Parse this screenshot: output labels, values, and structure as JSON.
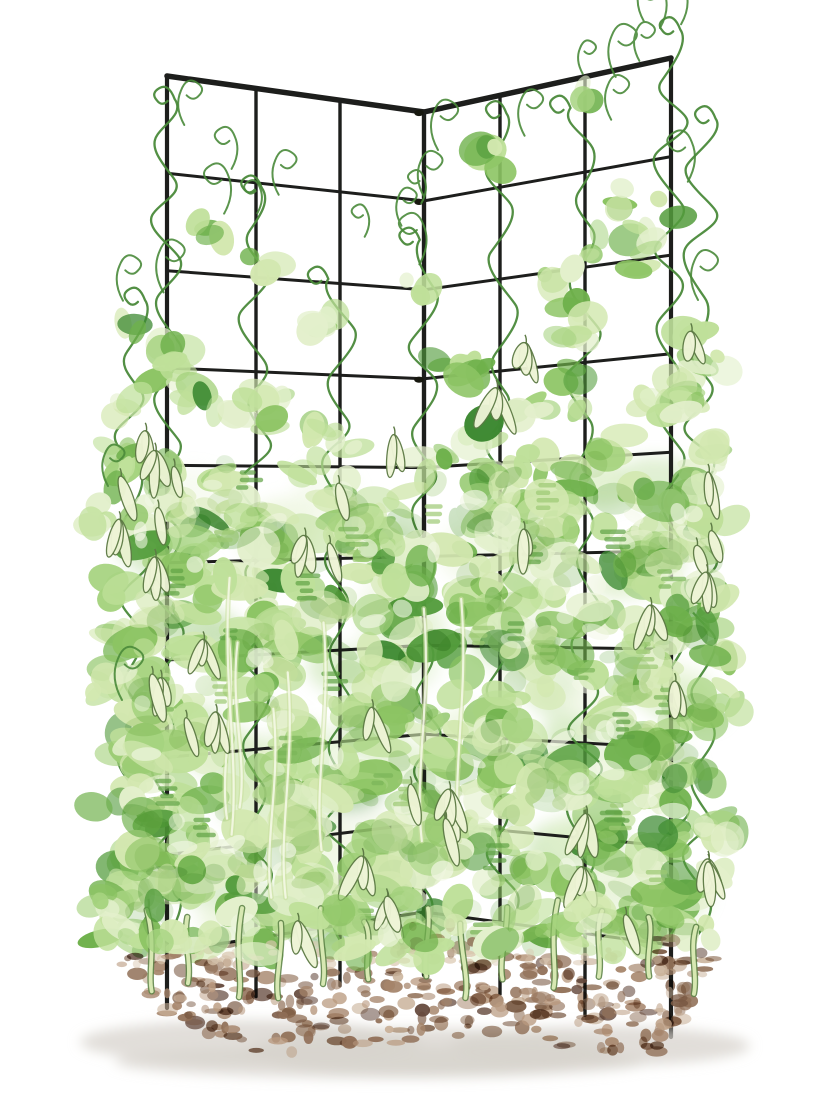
{
  "scene": {
    "width": 840,
    "height": 1120,
    "background": "#ffffff",
    "description": "Watercolor illustration of a two-panel corner pea trellis covered in climbing pea vines with hanging pea pods, planted in a mounded soil bed"
  },
  "palette": {
    "trellis": "#1d1e1c",
    "clamp": "#17180f",
    "vine": "#4a8a3a",
    "pod_fill": "#eef4d6",
    "pod_stroke": "#5d7a45",
    "stem_outline": "#5f8549",
    "stem_fill": "#d7e8b2",
    "light_stem_under": "#c9dfa0",
    "light_stem_top": "#f4f8e6",
    "highlight": "#f3f8e6",
    "soil_light": "#d9c6ae",
    "ground_shadow": "#d7d3cc",
    "leaf_weighted": [
      [
        "#e3f0cc",
        0.16
      ],
      [
        "#d3e8b0",
        0.22
      ],
      [
        "#bfe09a",
        0.2
      ],
      [
        "#a6d37f",
        0.16
      ],
      [
        "#8cc463",
        0.12
      ],
      [
        "#6fb14c",
        0.08
      ],
      [
        "#539c3c",
        0.04
      ],
      [
        "#3e8a33",
        0.02
      ]
    ],
    "leaf_texture": [
      "#9cc973",
      "#7ab558",
      "#5fa244"
    ],
    "soil_weighted": [
      [
        "#b99a7f",
        0.18
      ],
      [
        "#a5846a",
        0.26
      ],
      [
        "#8f6e55",
        0.26
      ],
      [
        "#7a5a44",
        0.14
      ],
      [
        "#c9b199",
        0.1
      ],
      [
        "#63473a",
        0.06
      ]
    ]
  },
  "trellis": {
    "rows": 10,
    "stroke": {
      "top_rail": 5.5,
      "outer_rail": 4.2,
      "vertical": 3.4,
      "horizontal": 3.0
    },
    "panels": [
      {
        "id": "left",
        "x0": 167,
        "x1": 424,
        "top0": 76,
        "top1": 112,
        "bot0": 952,
        "bot1": 912,
        "leg0": 56,
        "leg1": 63,
        "verticals": [
          167,
          256,
          340,
          424
        ]
      },
      {
        "id": "right",
        "x0": 424,
        "x1": 671,
        "top0": 112,
        "top1": 58,
        "bot0": 912,
        "bot1": 945,
        "leg0": 63,
        "leg1": 92,
        "verticals": [
          424,
          500,
          585,
          671
        ]
      }
    ],
    "corner": {
      "x": 424,
      "clamp_rows": [
        0,
        1,
        2,
        3
      ]
    }
  },
  "foliage": {
    "seed": 20240613,
    "columns": [
      {
        "x": 167,
        "start": 85,
        "density": 1.0
      },
      {
        "x": 256,
        "start": 160,
        "density": 0.95
      },
      {
        "x": 340,
        "start": 250,
        "density": 0.95
      },
      {
        "x": 424,
        "start": 215,
        "density": 0.9
      },
      {
        "x": 500,
        "start": 130,
        "density": 1.0
      },
      {
        "x": 585,
        "start": 85,
        "density": 1.0
      },
      {
        "x": 671,
        "start": 20,
        "density": 1.0
      },
      {
        "x": 132,
        "start": 300,
        "density": 0.8
      },
      {
        "x": 700,
        "start": 130,
        "density": 0.8
      }
    ],
    "back_wash": {
      "count": 60,
      "y_top": 480,
      "y_bottom": 930
    },
    "canopy": {
      "count": 250,
      "y_top": 470,
      "y_bottom": 952
    },
    "texture": {
      "count": 150,
      "opacity": 0.32
    },
    "highlights": {
      "count": 60
    },
    "dash_clusters": {
      "count": 36
    },
    "tendrils": {
      "count": 20,
      "fixed": [
        [
          660,
          28
        ],
        [
          698,
          300
        ],
        [
          108,
          486
        ],
        [
          122,
          700
        ],
        [
          438,
          150
        ]
      ]
    },
    "pods": {
      "count": 30,
      "left_edge": 4,
      "right_edge": 3
    },
    "light_stems": {
      "count": 8
    },
    "fringe": {
      "count": 35,
      "pods": 3
    }
  },
  "soil": {
    "x_min": 116,
    "x_max": 722,
    "top": 940,
    "bottom": 1056,
    "count": 330,
    "light_count": 50,
    "base_specks": 26,
    "shadows": [
      [
        250,
        1042,
        170,
        22
      ],
      [
        430,
        1052,
        185,
        24
      ],
      [
        600,
        1046,
        150,
        20
      ],
      [
        380,
        1062,
        265,
        16
      ]
    ]
  },
  "stems": {
    "count": 13,
    "x_start": 150,
    "x_end": 688
  }
}
